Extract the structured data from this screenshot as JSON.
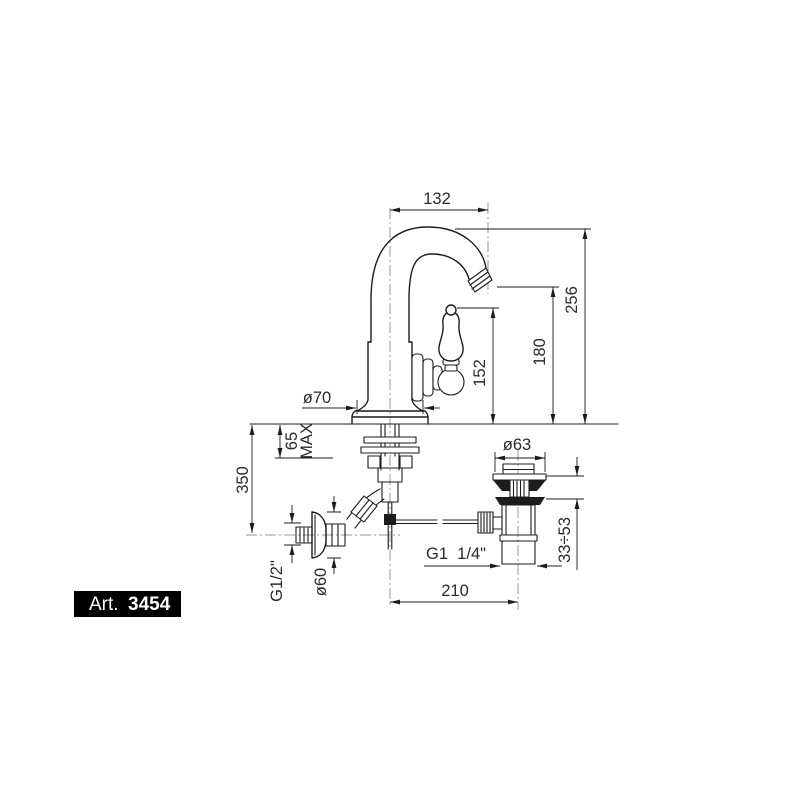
{
  "badge": {
    "prefix": "Art.",
    "number": "3454"
  },
  "dims": {
    "spout_reach": "132",
    "total_height": "256",
    "spout_height": "180",
    "handle_height": "152",
    "base_diameter": "ø70",
    "max_thickness_value": "65",
    "max_thickness_label": "MAX",
    "supply_drop": "350",
    "supply_thread": "G1/2\"",
    "flange_diameter": "ø60",
    "waste_flange_diameter": "ø63",
    "waste_clamp_range": "33÷53",
    "waste_thread": "G1  1/4\"",
    "drain_offset": "210"
  },
  "colors": {
    "line": "#1c1c1c",
    "centerline": "#979797",
    "badge_bg": "#000000",
    "badge_text": "#ffffff",
    "dim_text": "#2a2a2a",
    "paper": "#ffffff"
  }
}
